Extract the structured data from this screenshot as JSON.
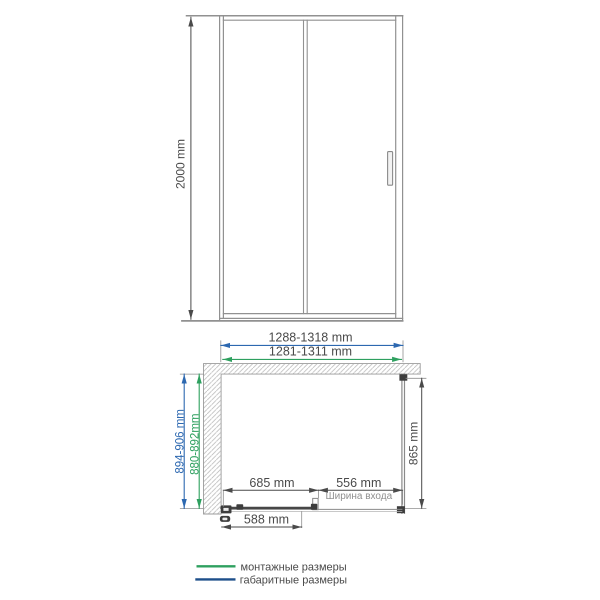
{
  "colors": {
    "dimension_blue": "#2d68b0",
    "dimension_green": "#2ea05f",
    "legend_navy": "#1d4f8a",
    "drawing_gray": "#919191",
    "text_dark": "#4a4a4a"
  },
  "front_view": {
    "height": "2000 mm"
  },
  "plan_view": {
    "overall_width": "1288-1318 mm",
    "mounting_width": "1281-1311 mm",
    "overall_depth": "894-906 mm",
    "mounting_depth": "880-892mm",
    "side_depth": "865 mm",
    "fixed_section_width": "685 mm",
    "entry_width": "556 mm",
    "entry_caption": "Ширина входа",
    "door_panel_width": "588 mm"
  },
  "legend": {
    "mounting": {
      "label": "монтажные размеры",
      "color": "#2ea05f"
    },
    "overall": {
      "label": "габаритные размеры",
      "color": "#1d4f8a"
    }
  }
}
